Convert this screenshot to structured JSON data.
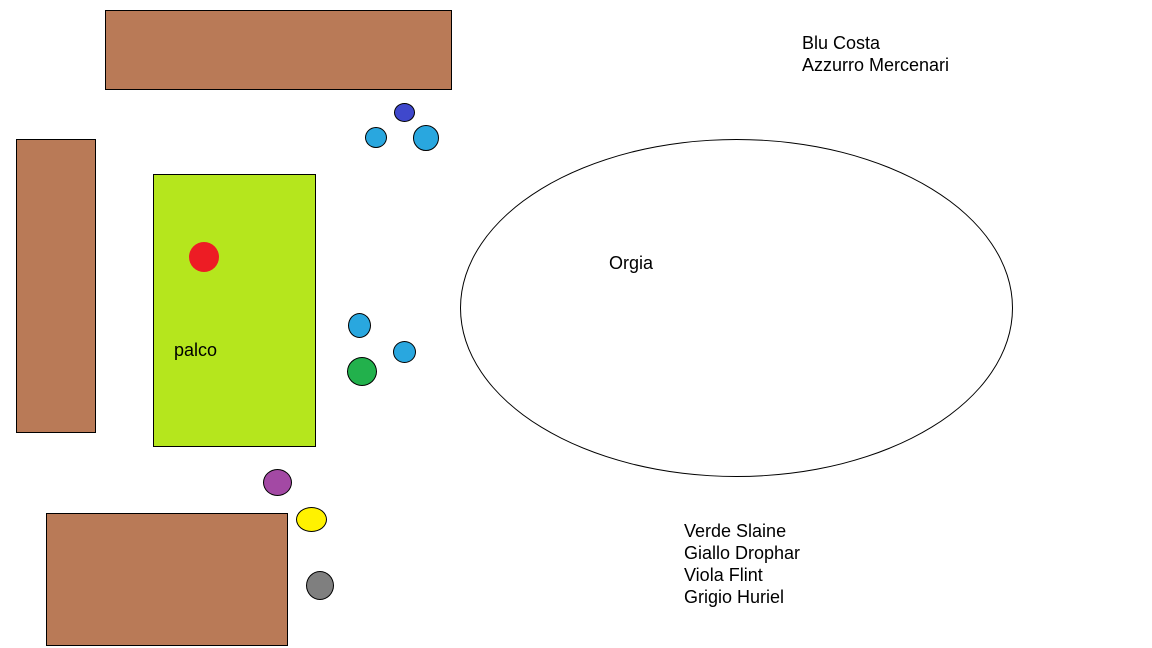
{
  "canvas": {
    "background": "#FFFFFF",
    "text_color": "#000000"
  },
  "tables": {
    "fill": "#B97A57",
    "border": "#000000",
    "items": [
      {
        "name": "table-top",
        "x": 105,
        "y": 10,
        "w": 347,
        "h": 80
      },
      {
        "name": "table-left",
        "x": 16,
        "y": 139,
        "w": 80,
        "h": 294
      },
      {
        "name": "table-bottom-left",
        "x": 46,
        "y": 513,
        "w": 242,
        "h": 133
      }
    ]
  },
  "stage": {
    "label": "palco",
    "fill": "#B5E61D",
    "border": "#000000",
    "x": 153,
    "y": 174,
    "w": 163,
    "h": 273,
    "label_pos": {
      "x": 20,
      "y": 164
    }
  },
  "orgia_zone": {
    "label": "Orgia",
    "border": "#000000",
    "x": 460,
    "y": 139,
    "w": 553,
    "h": 338,
    "label_pos": {
      "x": 148,
      "y": 112
    }
  },
  "markers": [
    {
      "name": "red-marker",
      "color": "#ED1C24",
      "x": 189,
      "y": 242,
      "w": 30,
      "h": 30,
      "border": false
    },
    {
      "name": "indigo-marker",
      "color": "#3F48CC",
      "x": 394,
      "y": 103,
      "w": 21,
      "h": 19,
      "border": true
    },
    {
      "name": "azure-marker-1",
      "color": "#29A7DF",
      "x": 365,
      "y": 127,
      "w": 22,
      "h": 21,
      "border": true
    },
    {
      "name": "azure-marker-2",
      "color": "#29A7DF",
      "x": 413,
      "y": 125,
      "w": 26,
      "h": 26,
      "border": true
    },
    {
      "name": "azure-marker-3",
      "color": "#29A7DF",
      "x": 348,
      "y": 313,
      "w": 23,
      "h": 25,
      "border": true
    },
    {
      "name": "azure-marker-4",
      "color": "#29A7DF",
      "x": 393,
      "y": 341,
      "w": 23,
      "h": 22,
      "border": true
    },
    {
      "name": "green-marker",
      "color": "#22B14C",
      "x": 347,
      "y": 357,
      "w": 30,
      "h": 29,
      "border": true
    },
    {
      "name": "purple-marker",
      "color": "#A349A4",
      "x": 263,
      "y": 469,
      "w": 29,
      "h": 27,
      "border": true
    },
    {
      "name": "yellow-marker",
      "color": "#FFF200",
      "x": 296,
      "y": 507,
      "w": 31,
      "h": 25,
      "border": true
    },
    {
      "name": "gray-marker",
      "color": "#7F7F7F",
      "x": 306,
      "y": 571,
      "w": 28,
      "h": 29,
      "border": true
    }
  ],
  "legend_top": {
    "x": 802,
    "y": 32,
    "lines": [
      "Blu Costa",
      "Azzurro Mercenari"
    ]
  },
  "legend_bottom": {
    "x": 684,
    "y": 520,
    "lines": [
      "Verde Slaine",
      "Giallo Drophar",
      "Viola Flint",
      "Grigio Huriel"
    ]
  }
}
